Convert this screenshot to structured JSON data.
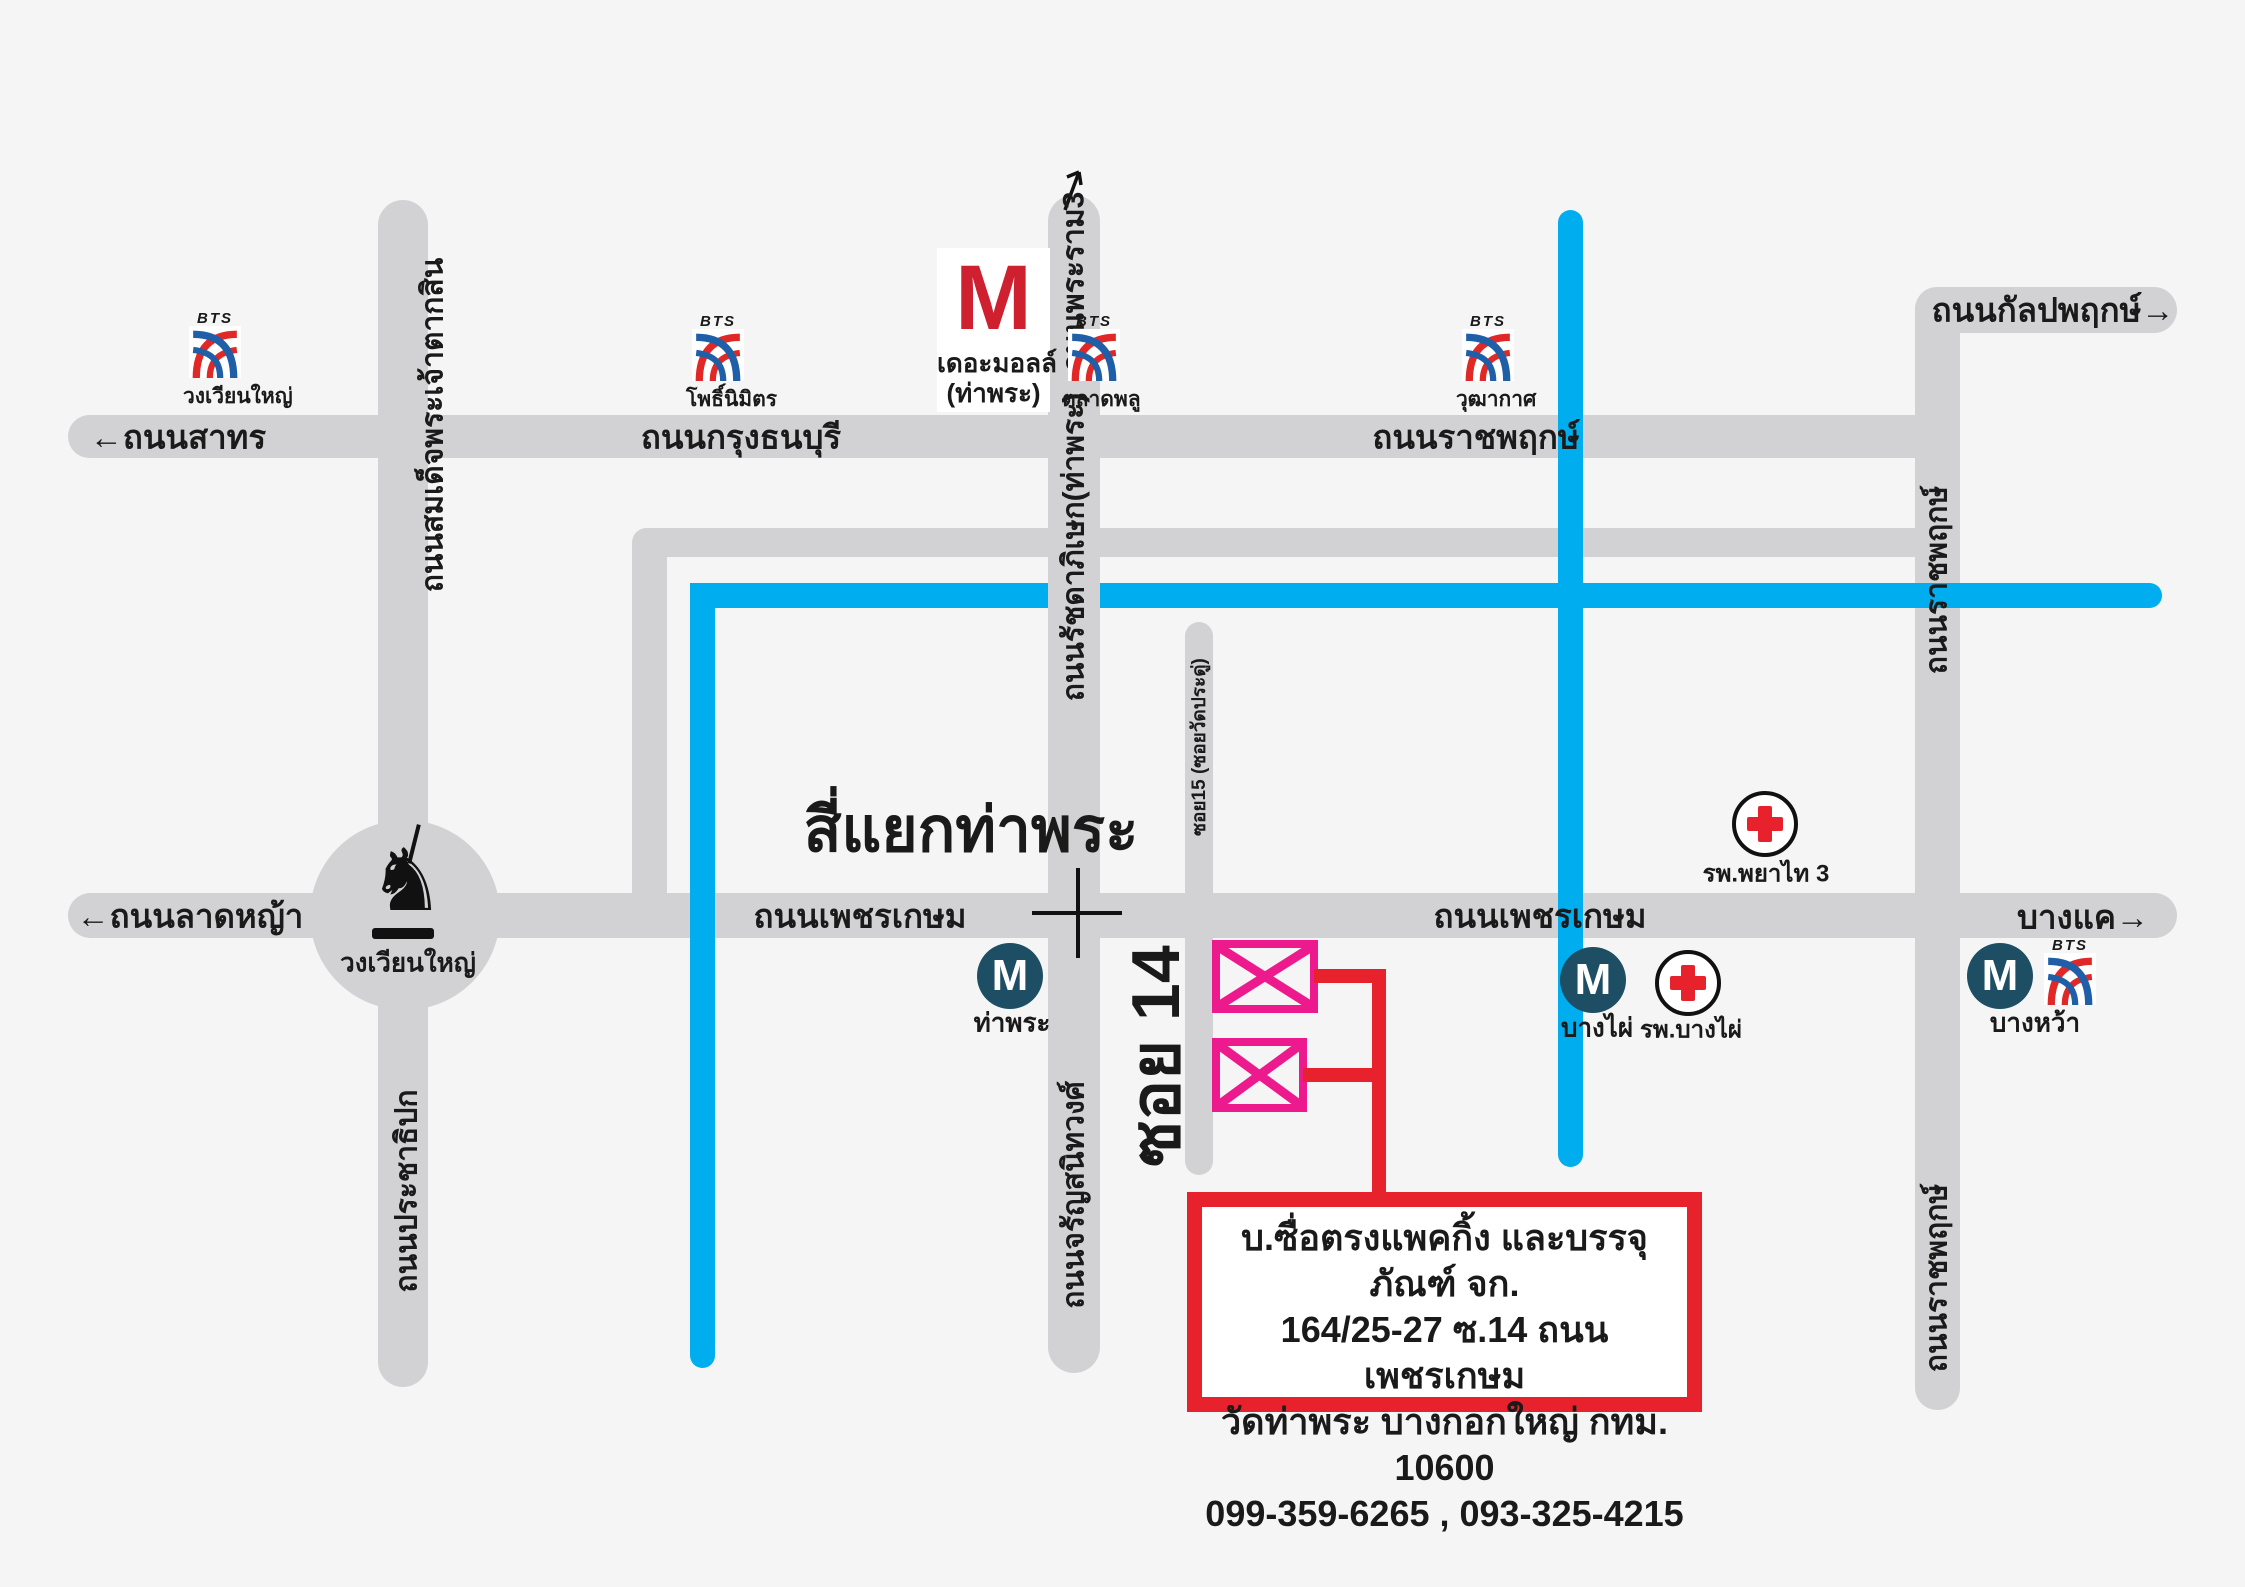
{
  "colors": {
    "background": "#f5f5f6",
    "road": "#d2d2d4",
    "canal": "#00aeef",
    "route_red": "#e8222d",
    "pink": "#ec1a8d",
    "mrt_blue": "#1d4e63",
    "mall_red": "#cf2030",
    "bts_red": "#e02826",
    "bts_blue": "#1f5fa8"
  },
  "roads": {
    "sathorn": "←ถนนสาทร",
    "krung_thonburi": "ถนนกรุงธนบุรี",
    "ratchaphruek_top": "ถนนราชพฤกษ์",
    "kanlapaphruek": "ถนนกัลปพฤกษ์→",
    "taksin": "ถนนสมเด็จพระเจ้าตากสิน",
    "prachathipok": "ถนนประชาธิปก",
    "rama3": "ถนนพระราม3",
    "ratchadaphisek": "ถนนรัชดาภิเษก(ท่าพระ)",
    "charansanitwong": "ถนนจรัญสนิทวงศ์",
    "ratchaphruek_right": "ถนนราชพฤกษ์",
    "ladya": "←ถนนลาดหญ้า",
    "phetkasem": "ถนนเพชรเกษม",
    "bangkhae": "บางแค→",
    "soi15": "ซอย15 (ซอยวัดประดู่)",
    "soi14": "ซอย 14"
  },
  "landmarks": {
    "intersection": "สี่แยกท่าพระ",
    "roundabout": "วงเวียนใหญ่",
    "mall_m": "M",
    "mall_name": "เดอะมอลล์",
    "mall_sub": "(ท่าพระ)"
  },
  "bts": {
    "brand": "BTS",
    "stations": [
      {
        "name": "วงเวียนใหญ่"
      },
      {
        "name": "โพธิ์นิมิตร"
      },
      {
        "name": "ตลาดพลู"
      },
      {
        "name": "วุฒากาศ"
      }
    ]
  },
  "mrt": {
    "letter": "M",
    "stations": [
      {
        "name": "ท่าพระ"
      },
      {
        "name": "บางไผ่"
      },
      {
        "name": "บางหว้า"
      }
    ]
  },
  "hospitals": [
    {
      "name": "รพ.พยาไท 3"
    },
    {
      "name": "รพ.บางไผ่"
    }
  ],
  "destination": {
    "line1": "บ.ซื่อตรงแพคกิ้ง และบรรจุภัณฑ์ จก.",
    "line2": "164/25-27 ซ.14 ถนนเพชรเกษม",
    "line3": "วัดท่าพระ บางกอกใหญ่ กทม. 10600",
    "line4": "099-359-6265 , 093-325-4215"
  }
}
